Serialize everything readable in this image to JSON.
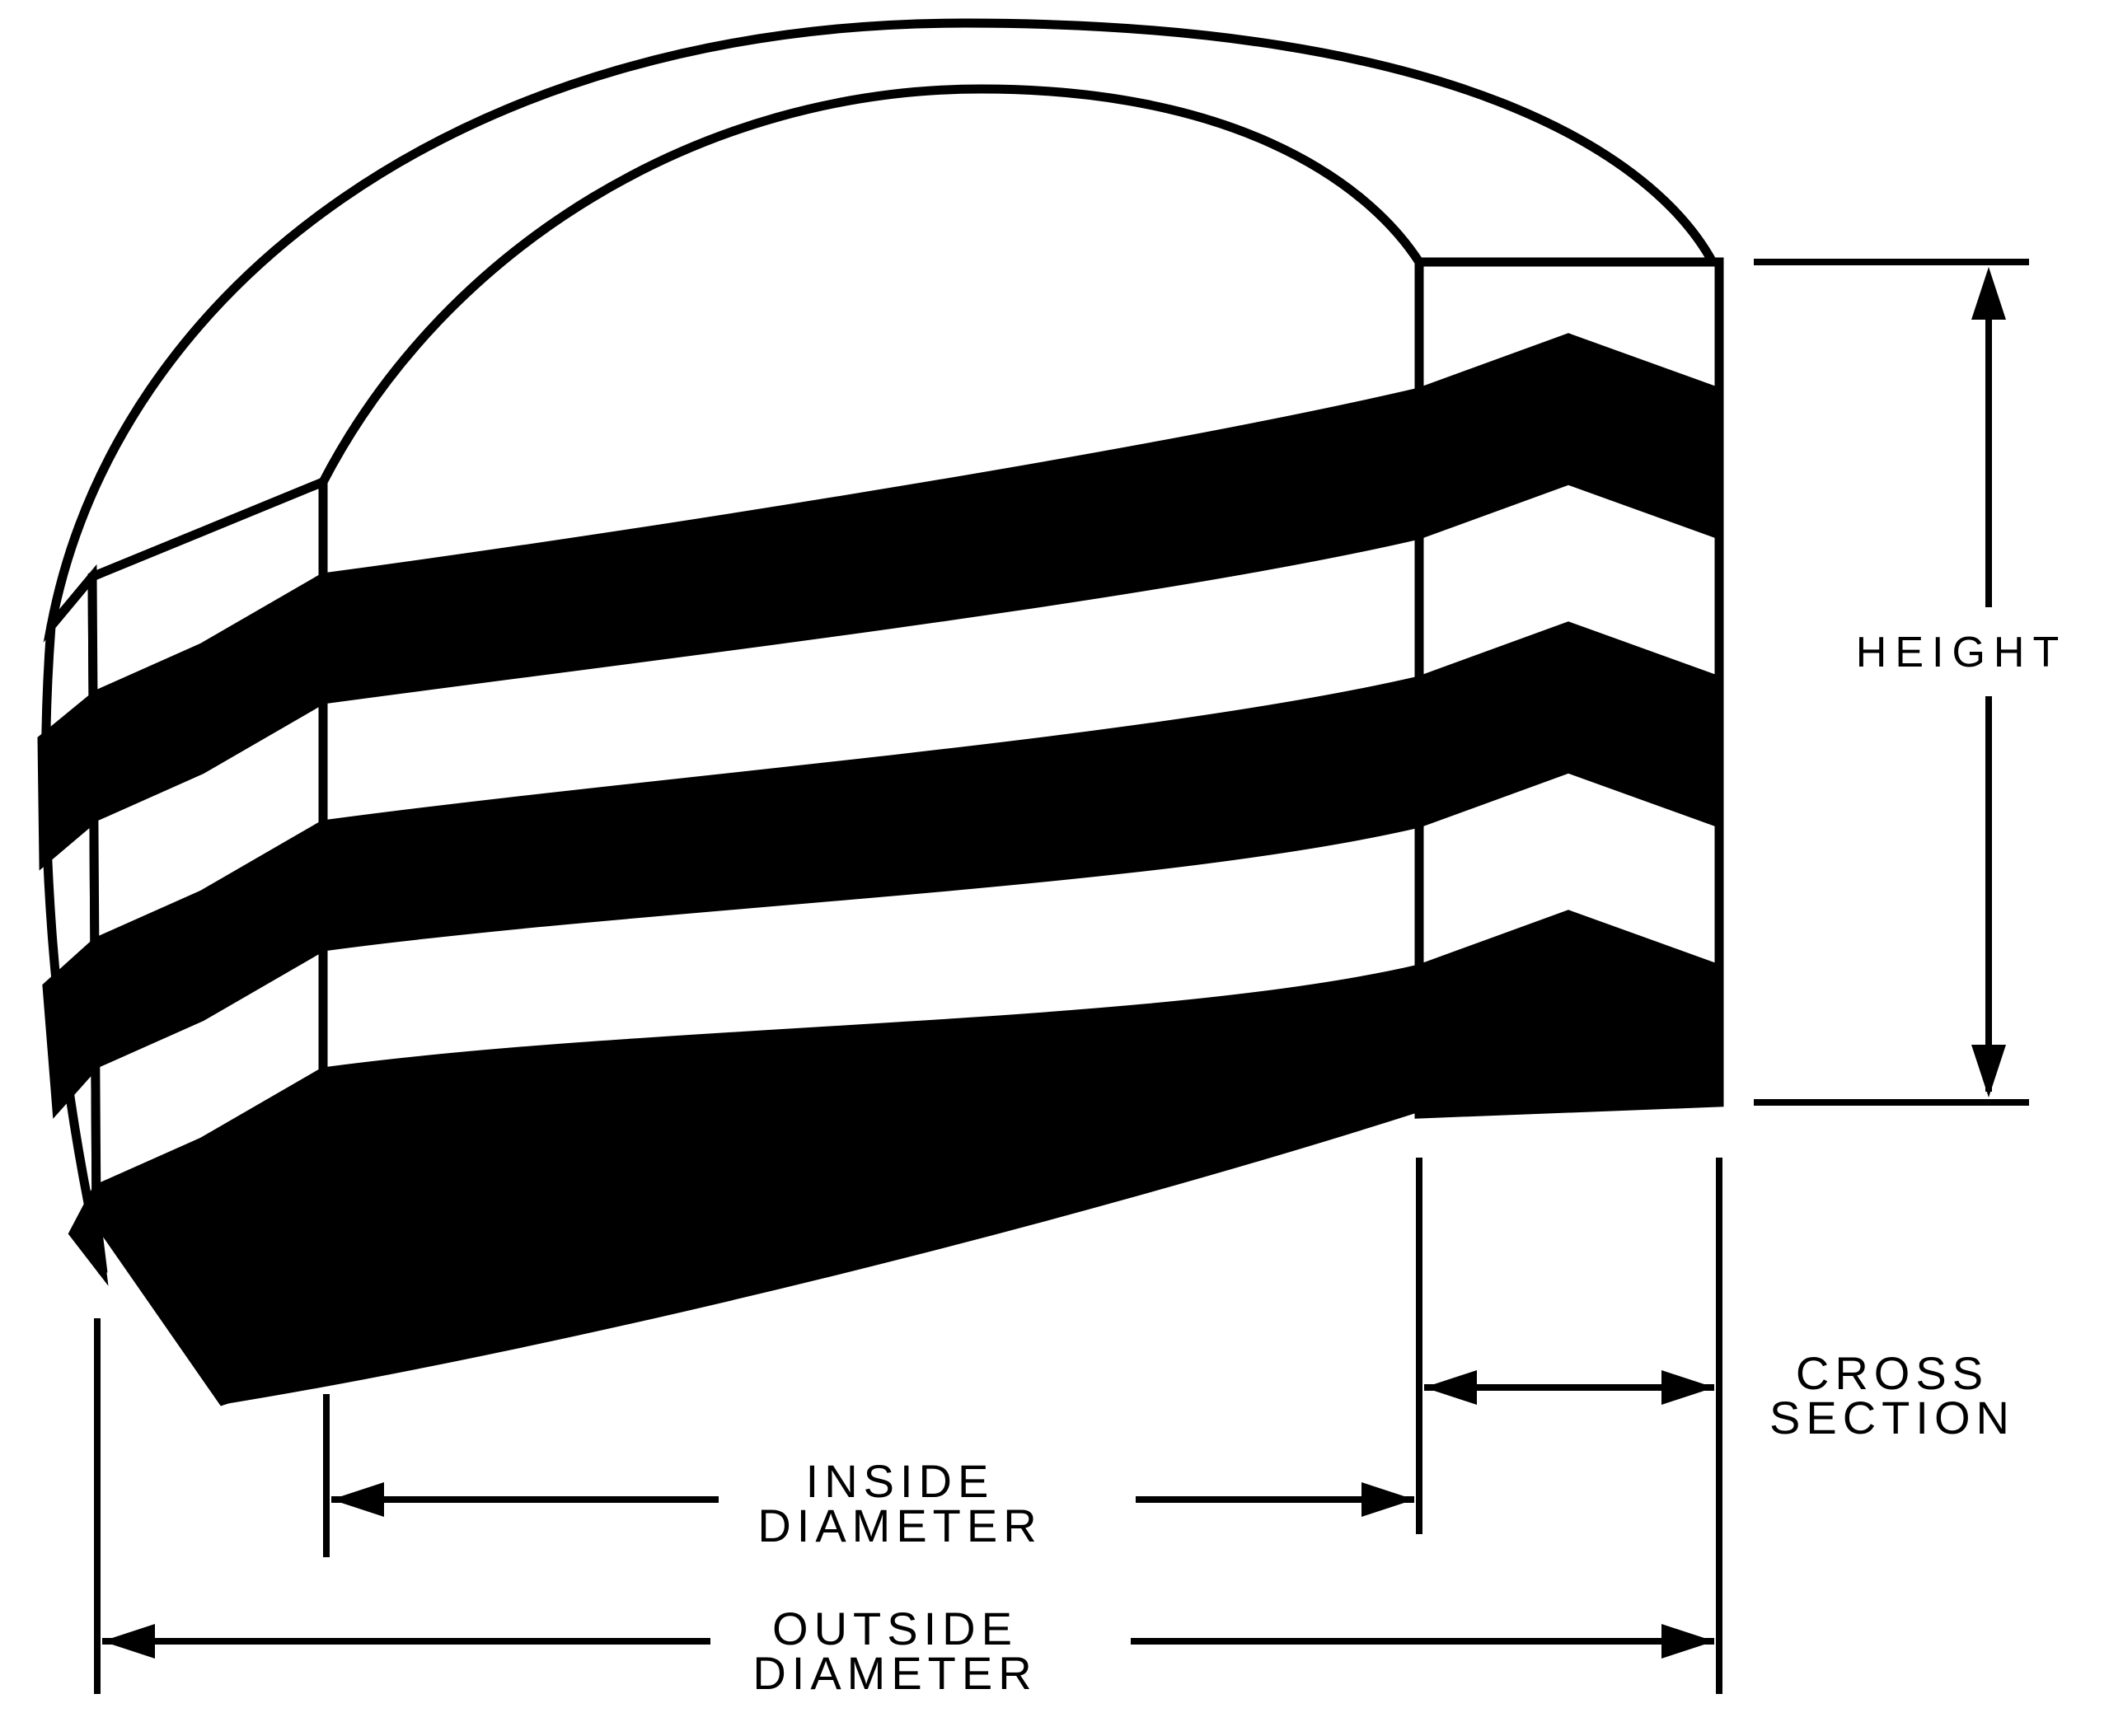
{
  "diagram": {
    "type": "engineering-cutaway",
    "subject": "Stacked chevron packing ring set, cutaway view",
    "colors": {
      "ink": "#000000",
      "background": "#ffffff"
    },
    "layer_pattern_top_to_bottom": [
      "white",
      "black",
      "white",
      "black",
      "white",
      "black"
    ],
    "dimensions": {
      "height": {
        "label": "HEIGHT"
      },
      "cross_section": {
        "line1": "CROSS",
        "line2": "SECTION"
      },
      "inside_diameter": {
        "line1": "INSIDE",
        "line2": "DIAMETER"
      },
      "outside_diameter": {
        "line1": "OUTSIDE",
        "line2": "DIAMETER"
      }
    }
  }
}
